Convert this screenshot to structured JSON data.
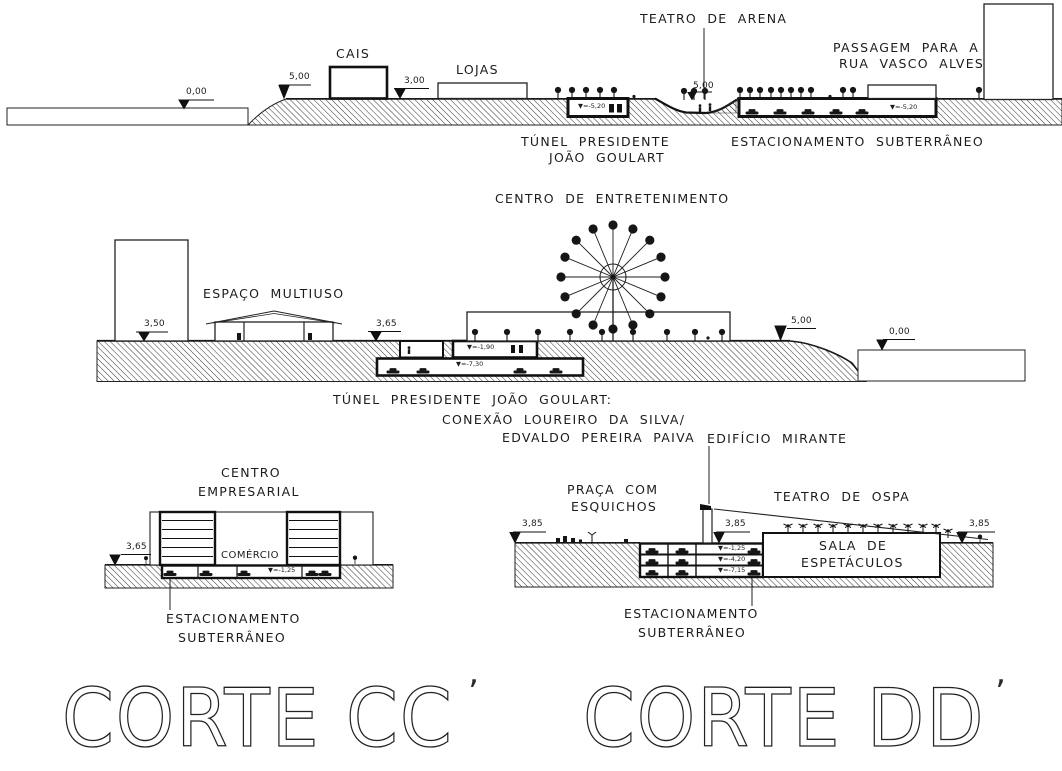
{
  "titles": {
    "left": "CORTE CC",
    "left_prime": "’",
    "right": "CORTE DD",
    "right_prime": "’"
  },
  "section_top": {
    "cais": "CAIS",
    "lojas": "LOJAS",
    "teatro_de_arena": "TEATRO DE ARENA",
    "passagem_l1": "PASSAGEM PARA A",
    "passagem_l2": "RUA VASCO ALVES",
    "tunel_l1": "TÚNEL PRESIDENTE",
    "tunel_l2": "JOÃO GOULART",
    "estacionamento": "ESTACIONAMENTO SUBTERRÂNEO",
    "elev_agua": "0,00",
    "elev_cais": "5,00",
    "elev_lojas": "3,00",
    "elev_arena": "5,00",
    "nivel_tunel": "▼=-5,20",
    "nivel_estacionamento": "▼=-5,20"
  },
  "section_middle": {
    "centro_de_entretenimento": "CENTRO DE ENTRETENIMENTO",
    "espaco_multiuso": "ESPAÇO MULTIUSO",
    "elev_predio": "3,50",
    "elev_plataforma": "3,65",
    "elev_borda": "5,00",
    "elev_agua": "0,00",
    "nivel_superior": "▼=-1,90",
    "nivel_inferior": "▼=-7,30",
    "nota_l1": "TÚNEL PRESIDENTE JOÃO GOULART:",
    "nota_l2": "CONEXÃO LOUREIRO DA SILVA/",
    "nota_l3": "EDVALDO PEREIRA PAIVA"
  },
  "section_bottom_left": {
    "titulo_l1": "CENTRO",
    "titulo_l2": "EMPRESARIAL",
    "comercio": "COMÉRCIO",
    "estacionamento_l1": "ESTACIONAMENTO",
    "estacionamento_l2": "SUBTERRÂNEO",
    "elev": "3,65",
    "nivel": "▼=-1,25"
  },
  "section_bottom_right": {
    "edificio_mirante": "EDIFÍCIO MIRANTE",
    "praca_l1": "PRAÇA COM",
    "praca_l2": "ESQUICHOS",
    "teatro": "TEATRO DE OSPA",
    "sala_l1": "SALA DE",
    "sala_l2": "ESPETÁCULOS",
    "estacionamento_l1": "ESTACIONAMENTO",
    "estacionamento_l2": "SUBTERRÂNEO",
    "elev_esquerda": "3,85",
    "elev_centro": "3,85",
    "elev_direita": "3,85",
    "nivel_1": "▼=-1,25",
    "nivel_2": "▼=-4,20",
    "nivel_3": "▼=-7,15"
  }
}
